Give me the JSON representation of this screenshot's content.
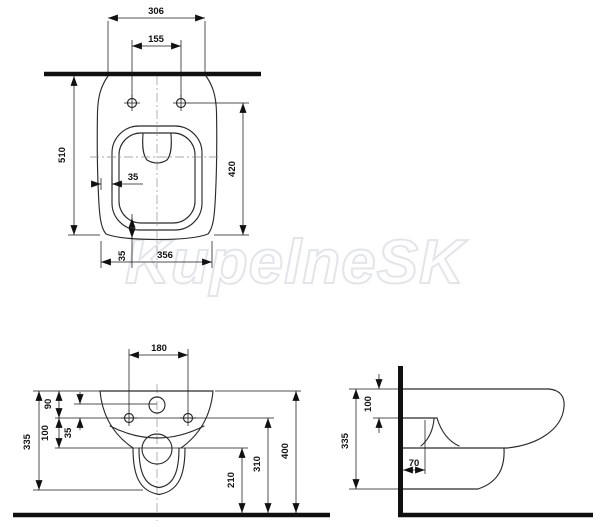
{
  "watermark": {
    "text": "KupelneSK"
  },
  "top_view": {
    "dims": {
      "width": "306",
      "seat_hole_spacing": "155",
      "depth": "510",
      "bowl_length": "420",
      "rim_offset": "35",
      "bottom_offset": "35",
      "bottom_width": "356"
    }
  },
  "front_view": {
    "dims": {
      "fixing_hole_spacing": "180",
      "top_to_holes": "90",
      "holes_to_drain": "100",
      "inlet_offset": "35",
      "body_height": "335",
      "drain_height": "210",
      "holes_height": "310",
      "top_height": "400"
    }
  },
  "side_view": {
    "dims": {
      "top_to_seat": "100",
      "body_height": "335",
      "drain_wall_offset": "70"
    }
  }
}
